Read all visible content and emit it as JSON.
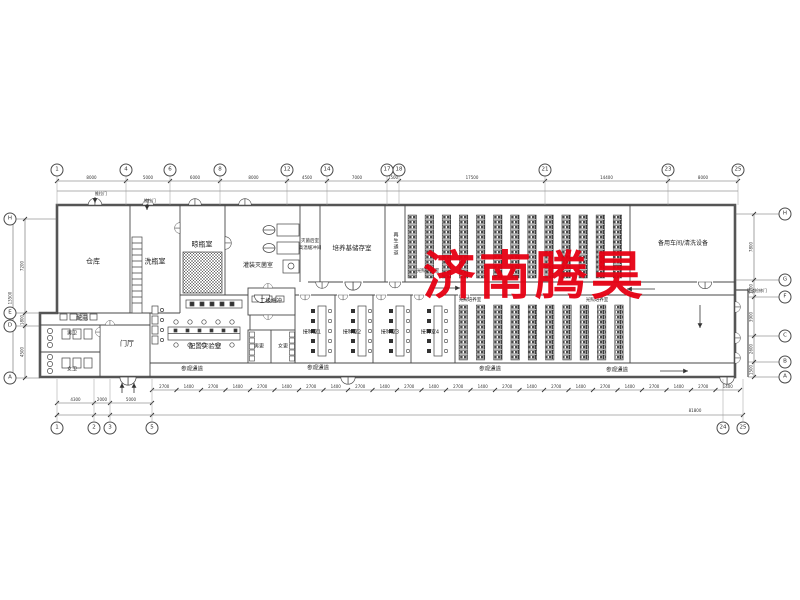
{
  "sheet": {
    "background": "#ffffff",
    "line_color": "#3c3c3c",
    "wall_color": "#555555"
  },
  "watermark": {
    "text": "济南腾昊",
    "color": "#e60012"
  },
  "rooms": {
    "cangku": "仓库",
    "xiping": "洗瓶室",
    "liangping": "晾瓶室",
    "guanzhuang": "灌装灭菌室",
    "miejunhou": "灭菌后室",
    "gaowen": "高温缓冲间",
    "peiyangji": "培养基储存室",
    "zaisheng": "再生通道",
    "guangzhao_upper": "光照培养室",
    "beiyong": "备用车间/清洗设备",
    "erji": "二级缓冲",
    "peidian": "配电",
    "nanwei": "男卫",
    "nvwei": "女卫",
    "menting": "门厅",
    "peizhi": "配置实验室",
    "nangeng": "男更",
    "nvgeng": "女更",
    "jiezhong1": "接种室1",
    "jiezhong2": "接种室2",
    "jiezhong3": "接种室3",
    "jiezhong4": "接种室4",
    "guangzhao_lower": "光照培养室",
    "guangzhao_lower2": "光照培养室"
  },
  "corridors": {
    "canguan": "参观通道"
  },
  "door_labels": {
    "tuila": "推拉门",
    "jianxiu": "管道检修门"
  },
  "axes": {
    "top": [
      "1",
      "4",
      "6",
      "8",
      "12",
      "14",
      "17",
      "18",
      "21",
      "23",
      "25"
    ],
    "bottom_left": [
      "1",
      "2",
      "3",
      "5"
    ],
    "bottom_right": [
      "24",
      "25"
    ],
    "left": [
      "H",
      "E",
      "D",
      "A"
    ],
    "right": [
      "H",
      "G",
      "F",
      "C",
      "B",
      "A"
    ]
  },
  "dimensions": {
    "top": [
      "8000",
      "5000",
      "6000",
      "8000",
      "4500",
      "7000",
      "1500",
      "17500",
      "14400",
      "8000"
    ],
    "bottom_left": [
      "4300",
      "2000",
      "5000"
    ],
    "bottom_chain": [
      "2700",
      "1400"
    ],
    "bottom_total": "81800",
    "left": [
      "7200",
      "1800",
      "4500"
    ],
    "left_total": "13500",
    "right": [
      "7800",
      "1700",
      "3900",
      "2600",
      "1500"
    ]
  },
  "racks": {
    "upper_columns": 13,
    "lower_columns": 10
  }
}
